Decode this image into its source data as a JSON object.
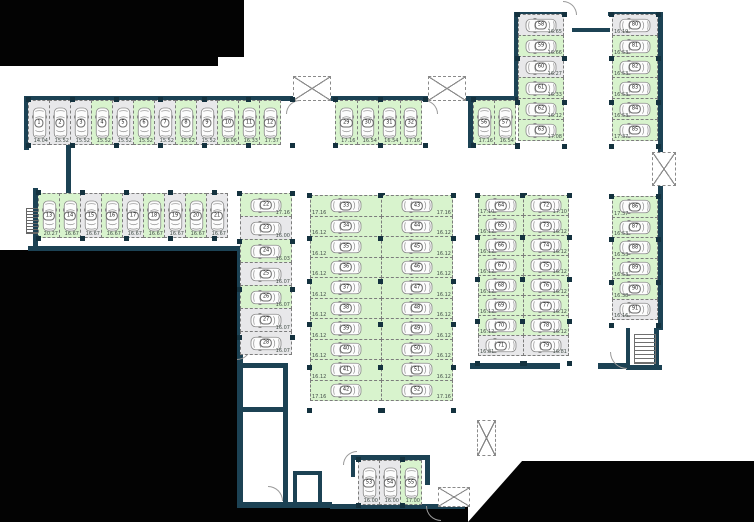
{
  "title": "Parking level floor plan",
  "colors": {
    "available_fill": "#d8f3cd",
    "occupied_fill": "#e8e8ea",
    "wall": "#1c4254",
    "outside": "#030303",
    "bay_border": "#7c7c7c"
  },
  "icons": {
    "car": "car-icon",
    "shaft": "vent-shaft-icon",
    "stairs": "stairs-icon",
    "ladder": "ladder-icon",
    "door": "door-arc"
  },
  "groups": {
    "row1": {
      "label": "spaces 1-12",
      "spaces": [
        {
          "n": "1",
          "area": "14.04",
          "state": "gray"
        },
        {
          "n": "2",
          "area": "15.52",
          "state": "gray"
        },
        {
          "n": "3",
          "area": "15.52",
          "state": "gray"
        },
        {
          "n": "4",
          "area": "15.52",
          "state": "green"
        },
        {
          "n": "5",
          "area": "15.52",
          "state": "gray"
        },
        {
          "n": "6",
          "area": "15.52",
          "state": "green"
        },
        {
          "n": "7",
          "area": "15.52",
          "state": "gray"
        },
        {
          "n": "8",
          "area": "15.52",
          "state": "green"
        },
        {
          "n": "9",
          "area": "15.52",
          "state": "gray"
        },
        {
          "n": "10",
          "area": "16.06",
          "state": "green"
        },
        {
          "n": "11",
          "area": "16.33",
          "state": "green"
        },
        {
          "n": "12",
          "area": "17.37",
          "state": "green"
        }
      ]
    },
    "row2": {
      "label": "spaces 13-21",
      "spaces": [
        {
          "n": "13",
          "area": "20.27",
          "state": "green"
        },
        {
          "n": "14",
          "area": "16.67",
          "state": "green"
        },
        {
          "n": "15",
          "area": "16.67",
          "state": "gray"
        },
        {
          "n": "16",
          "area": "16.67",
          "state": "green"
        },
        {
          "n": "17",
          "area": "16.67",
          "state": "gray"
        },
        {
          "n": "18",
          "area": "16.67",
          "state": "green"
        },
        {
          "n": "19",
          "area": "16.67",
          "state": "gray"
        },
        {
          "n": "20",
          "area": "16.67",
          "state": "green"
        },
        {
          "n": "21",
          "area": "16.67",
          "state": "gray"
        }
      ]
    },
    "col22": {
      "label": "spaces 22-28",
      "spaces": [
        {
          "n": "22",
          "area": "17.16",
          "state": "green"
        },
        {
          "n": "23",
          "area": "16.00",
          "state": "gray"
        },
        {
          "n": "24",
          "area": "16.03",
          "state": "green"
        },
        {
          "n": "25",
          "area": "16.07",
          "state": "gray"
        },
        {
          "n": "26",
          "area": "16.07",
          "state": "green"
        },
        {
          "n": "27",
          "area": "16.07",
          "state": "gray"
        },
        {
          "n": "28",
          "area": "16.07",
          "state": "gray"
        }
      ]
    },
    "row29": {
      "label": "spaces 29-32",
      "spaces": [
        {
          "n": "29",
          "area": "17.16",
          "state": "green"
        },
        {
          "n": "30",
          "area": "16.54",
          "state": "green"
        },
        {
          "n": "31",
          "area": "16.54",
          "state": "green"
        },
        {
          "n": "32",
          "area": "17.16",
          "state": "green"
        }
      ]
    },
    "col33": {
      "label": "spaces 33-42",
      "spaces": [
        {
          "n": "33",
          "area": "17.16",
          "state": "green"
        },
        {
          "n": "34",
          "area": "16.12",
          "state": "green"
        },
        {
          "n": "35",
          "area": "16.12",
          "state": "green"
        },
        {
          "n": "36",
          "area": "16.12",
          "state": "green"
        },
        {
          "n": "37",
          "area": "16.12",
          "state": "green"
        },
        {
          "n": "38",
          "area": "16.12",
          "state": "green"
        },
        {
          "n": "39",
          "area": "16.12",
          "state": "green"
        },
        {
          "n": "40",
          "area": "16.12",
          "state": "green"
        },
        {
          "n": "41",
          "area": "16.12",
          "state": "green"
        },
        {
          "n": "42",
          "area": "17.16",
          "state": "green"
        }
      ]
    },
    "col43": {
      "label": "spaces 43-52",
      "spaces": [
        {
          "n": "43",
          "area": "17.16",
          "state": "green"
        },
        {
          "n": "44",
          "area": "16.12",
          "state": "green"
        },
        {
          "n": "45",
          "area": "16.12",
          "state": "green"
        },
        {
          "n": "46",
          "area": "16.12",
          "state": "green"
        },
        {
          "n": "47",
          "area": "16.12",
          "state": "green"
        },
        {
          "n": "48",
          "area": "16.12",
          "state": "green"
        },
        {
          "n": "49",
          "area": "16.12",
          "state": "green"
        },
        {
          "n": "50",
          "area": "16.12",
          "state": "green"
        },
        {
          "n": "51",
          "area": "16.12",
          "state": "green"
        },
        {
          "n": "52",
          "area": "17.16",
          "state": "green"
        }
      ]
    },
    "row53": {
      "label": "spaces 53-55",
      "spaces": [
        {
          "n": "53",
          "area": "16.00",
          "state": "gray"
        },
        {
          "n": "54",
          "area": "16.00",
          "state": "gray"
        },
        {
          "n": "55",
          "area": "17.00",
          "state": "green"
        }
      ]
    },
    "row56": {
      "label": "spaces 56-57",
      "spaces": [
        {
          "n": "56",
          "area": "17.16",
          "state": "green"
        },
        {
          "n": "57",
          "area": "16.54",
          "state": "green"
        }
      ]
    },
    "col58": {
      "label": "spaces 58-63",
      "spaces": [
        {
          "n": "58",
          "area": "16.65",
          "state": "gray"
        },
        {
          "n": "59",
          "area": "16.66",
          "state": "green"
        },
        {
          "n": "60",
          "area": "16.27",
          "state": "gray"
        },
        {
          "n": "61",
          "area": "16.33",
          "state": "green"
        },
        {
          "n": "62",
          "area": "16.12",
          "state": "green"
        },
        {
          "n": "63",
          "area": "17.08",
          "state": "green"
        }
      ]
    },
    "col80": {
      "label": "spaces 80-85",
      "spaces": [
        {
          "n": "80",
          "area": "16.19",
          "state": "gray"
        },
        {
          "n": "81",
          "area": "16.53",
          "state": "green"
        },
        {
          "n": "82",
          "area": "16.53",
          "state": "green"
        },
        {
          "n": "83",
          "area": "16.53",
          "state": "green"
        },
        {
          "n": "84",
          "area": "16.53",
          "state": "green"
        },
        {
          "n": "85",
          "area": "17.37",
          "state": "green"
        }
      ]
    },
    "col64": {
      "label": "spaces 64-71",
      "spaces": [
        {
          "n": "64",
          "area": "17.10",
          "state": "green"
        },
        {
          "n": "65",
          "area": "16.12",
          "state": "green"
        },
        {
          "n": "66",
          "area": "16.12",
          "state": "green"
        },
        {
          "n": "67",
          "area": "16.12",
          "state": "green"
        },
        {
          "n": "68",
          "area": "16.12",
          "state": "green"
        },
        {
          "n": "69",
          "area": "16.12",
          "state": "green"
        },
        {
          "n": "70",
          "area": "16.12",
          "state": "green"
        },
        {
          "n": "71",
          "area": "16.81",
          "state": "gray"
        }
      ]
    },
    "col72": {
      "label": "spaces 72-79",
      "spaces": [
        {
          "n": "72",
          "area": "17.10",
          "state": "green"
        },
        {
          "n": "73",
          "area": "16.12",
          "state": "green"
        },
        {
          "n": "74",
          "area": "16.12",
          "state": "green"
        },
        {
          "n": "75",
          "area": "16.12",
          "state": "green"
        },
        {
          "n": "76",
          "area": "16.12",
          "state": "green"
        },
        {
          "n": "77",
          "area": "16.12",
          "state": "green"
        },
        {
          "n": "78",
          "area": "16.12",
          "state": "green"
        },
        {
          "n": "79",
          "area": "16.81",
          "state": "gray"
        }
      ]
    },
    "col86": {
      "label": "spaces 86-91",
      "spaces": [
        {
          "n": "86",
          "area": "17.37",
          "state": "green"
        },
        {
          "n": "87",
          "area": "16.53",
          "state": "green"
        },
        {
          "n": "88",
          "area": "16.53",
          "state": "green"
        },
        {
          "n": "89",
          "area": "16.53",
          "state": "green"
        },
        {
          "n": "90",
          "area": "16.38",
          "state": "green"
        },
        {
          "n": "91",
          "area": "16.16",
          "state": "gray"
        }
      ]
    }
  }
}
